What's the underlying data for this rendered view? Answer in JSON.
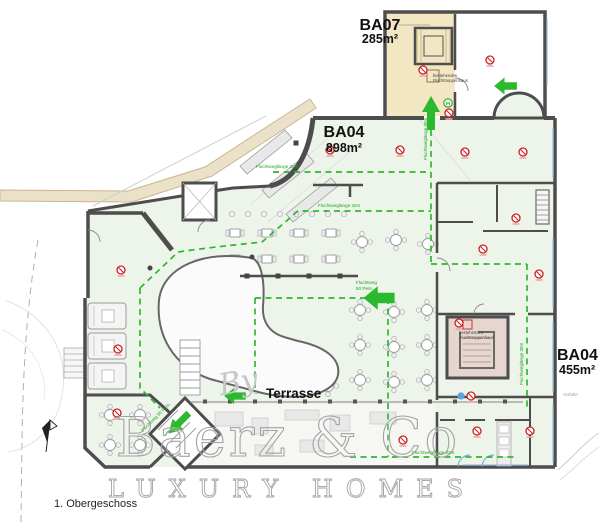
{
  "meta": {
    "floor_label": "1. Obergeschoss"
  },
  "areas": {
    "ba07": {
      "code": "BA07",
      "area": "285m²"
    },
    "ba04_main": {
      "code": "BA04",
      "area": "898m²"
    },
    "ba04_east": {
      "code": "BA04",
      "area": "455m²"
    }
  },
  "labels": {
    "terrace": "Terrasse",
    "driveway": "Vorfahrt"
  },
  "stair_note": {
    "l1": "bestehendes",
    "l2": "Fluchttreppenhaus"
  },
  "escape": {
    "len32": "Fluchtweglänge 32m",
    "len35": "Fluchtweglänge 35m",
    "len22": "Fluchtweglänge 22m",
    "flow_l1": "Fluchtweg",
    "flow_l2": "50 Pers.",
    "flow_full": "Fluchtweg 50 Pers."
  },
  "symbols": {
    "hydrant": "H"
  },
  "watermark": {
    "prefix": "By",
    "brand": "Baerz & Co",
    "tagline": "LUXURY HOMES"
  },
  "colors": {
    "escape_green": "#2db92d",
    "marker_red": "#cc2222",
    "ba07_fill": "#f3e6c3",
    "stairwell_fill": "#e7d6d0",
    "hall_fill": "#edf4ea",
    "wall": "#4d4d4d",
    "terrain": "#ebe1c9"
  }
}
